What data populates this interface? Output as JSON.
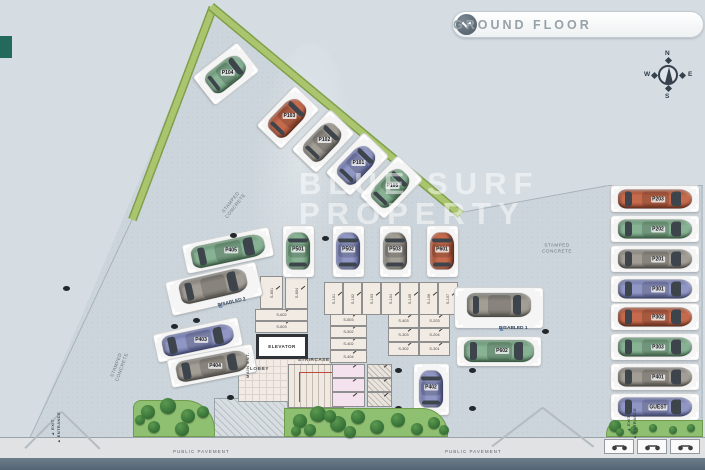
{
  "header": {
    "title": "GROUND FLOOR"
  },
  "compass": {
    "north": "N",
    "east": "E",
    "south": "S",
    "west": "W"
  },
  "watermark": {
    "line1": "BLUE SURF",
    "line2": "PROPERTY"
  },
  "plan": {
    "floor_polygon": [
      [
        213,
        6
      ],
      [
        461,
        213
      ],
      [
        608,
        186
      ],
      [
        703,
        186
      ],
      [
        703,
        438
      ],
      [
        30,
        438
      ]
    ],
    "edges": [
      {
        "x1": 133,
        "y1": 218,
        "x2": 30,
        "y2": 438
      },
      {
        "x1": 461,
        "y1": 213,
        "x2": 608,
        "y2": 186
      },
      {
        "x1": 608,
        "y1": 186,
        "x2": 703,
        "y2": 186
      },
      {
        "x1": 702,
        "y1": 186,
        "x2": 702,
        "y2": 438
      }
    ],
    "green_strips": [
      {
        "x": 213,
        "y": 7,
        "len": 227,
        "angle": 110.8
      },
      {
        "x": 211,
        "y": 6,
        "len": 325,
        "angle": 39.8
      }
    ],
    "driveway_lines": [
      {
        "x1": 62,
        "y1": 412,
        "x2": 25,
        "y2": 449
      },
      {
        "x1": 62,
        "y1": 412,
        "x2": 100,
        "y2": 449
      },
      {
        "x1": 543,
        "y1": 408,
        "x2": 492,
        "y2": 447
      },
      {
        "x1": 543,
        "y1": 408,
        "x2": 594,
        "y2": 447
      }
    ],
    "area_labels": [
      {
        "lines": "STAMPED\nCONCRETE",
        "x": 233,
        "y": 204,
        "rot": -52
      },
      {
        "lines": "STAMPED\nCONCRETE",
        "x": 557,
        "y": 248,
        "rot": 0
      },
      {
        "lines": "STAMPED\nCONCRETE",
        "x": 119,
        "y": 366,
        "rot": -70
      }
    ],
    "pavement_labels": [
      {
        "text": "PUBLIC PAVEMENT",
        "x": 173,
        "y": 449
      },
      {
        "text": "PUBLIC PAVEMENT",
        "x": 445,
        "y": 449
      }
    ],
    "exit_labels": [
      {
        "lines": "▲ EXIT\n▲ ENTRANCE",
        "x": 40,
        "y": 422
      },
      {
        "lines": "▲ EXIT\n▲ ENTRANCE",
        "x": 616,
        "y": 418
      }
    ],
    "rooms": {
      "elevator": {
        "label": "ELEVATOR",
        "x": 256,
        "y": 334,
        "w": 52,
        "h": 25
      },
      "lobby": {
        "label": "LOBBY",
        "x": 238,
        "y": 358,
        "w": 94,
        "h": 44
      },
      "staircase": {
        "label": "STAIRCASE",
        "x": 288,
        "y": 364,
        "w": 56,
        "h": 44
      },
      "main_entrance": {
        "label": "MAIN ENT.",
        "x": 245,
        "y": 378
      },
      "entrance_hatch": {
        "x": 214,
        "y": 398,
        "w": 74,
        "h": 39
      },
      "wall_bar": {
        "x": 386,
        "y": 306,
        "w": 64,
        "h": 5
      }
    },
    "storage_units": [
      {
        "label": "S-601",
        "x": 260,
        "y": 276,
        "w": 23,
        "h": 33,
        "vert": true
      },
      {
        "label": "S-604",
        "x": 285,
        "y": 276,
        "w": 23,
        "h": 33,
        "vert": true
      },
      {
        "label": "S-602",
        "x": 255,
        "y": 309,
        "w": 53,
        "h": 12
      },
      {
        "label": "S-603",
        "x": 255,
        "y": 321,
        "w": 53,
        "h": 12
      },
      {
        "label": "S-101",
        "x": 324,
        "y": 282,
        "w": 19,
        "h": 33,
        "vert": true
      },
      {
        "label": "S-102",
        "x": 343,
        "y": 282,
        "w": 19,
        "h": 33,
        "vert": true
      },
      {
        "label": "S-103",
        "x": 362,
        "y": 282,
        "w": 19,
        "h": 33,
        "vert": true
      },
      {
        "label": "S-104",
        "x": 381,
        "y": 282,
        "w": 19,
        "h": 33,
        "vert": true
      },
      {
        "label": "S-105",
        "x": 400,
        "y": 282,
        "w": 19,
        "h": 33,
        "vert": true
      },
      {
        "label": "S-106",
        "x": 419,
        "y": 282,
        "w": 19,
        "h": 33,
        "vert": true
      },
      {
        "label": "S-107",
        "x": 438,
        "y": 282,
        "w": 20,
        "h": 33,
        "vert": true
      },
      {
        "label": "S-503",
        "x": 330,
        "y": 314,
        "w": 37,
        "h": 12
      },
      {
        "label": "S-502",
        "x": 330,
        "y": 326,
        "w": 37,
        "h": 12
      },
      {
        "label": "S-402",
        "x": 330,
        "y": 338,
        "w": 37,
        "h": 12
      },
      {
        "label": "S-404",
        "x": 330,
        "y": 350,
        "w": 37,
        "h": 13
      },
      {
        "label": "",
        "x": 332,
        "y": 364,
        "w": 33,
        "h": 14,
        "style": "pink"
      },
      {
        "label": "",
        "x": 332,
        "y": 378,
        "w": 33,
        "h": 14,
        "style": "pink"
      },
      {
        "label": "",
        "x": 332,
        "y": 392,
        "w": 33,
        "h": 15,
        "style": "pink"
      },
      {
        "label": "",
        "x": 367,
        "y": 364,
        "w": 25,
        "h": 14,
        "style": "hatch"
      },
      {
        "label": "",
        "x": 367,
        "y": 378,
        "w": 25,
        "h": 14,
        "style": "hatch"
      },
      {
        "label": "",
        "x": 367,
        "y": 392,
        "w": 25,
        "h": 15,
        "style": "hatch"
      },
      {
        "label": "S-403",
        "x": 388,
        "y": 314,
        "w": 31,
        "h": 14
      },
      {
        "label": "S-203",
        "x": 419,
        "y": 314,
        "w": 31,
        "h": 14
      },
      {
        "label": "S-303",
        "x": 388,
        "y": 328,
        "w": 31,
        "h": 14
      },
      {
        "label": "S-204",
        "x": 419,
        "y": 328,
        "w": 31,
        "h": 14
      },
      {
        "label": "S-302",
        "x": 388,
        "y": 342,
        "w": 31,
        "h": 14
      },
      {
        "label": "S-301",
        "x": 419,
        "y": 342,
        "w": 31,
        "h": 14
      }
    ],
    "parking_spots": [
      {
        "label": "P104",
        "cx": 226,
        "cy": 74,
        "w": 36,
        "h": 56,
        "rot": 52,
        "car": 0,
        "color": "green"
      },
      {
        "label": "P103",
        "cx": 288,
        "cy": 117,
        "w": 34,
        "h": 55,
        "rot": 44,
        "car": 0,
        "color": "orange"
      },
      {
        "label": "P102",
        "cx": 323,
        "cy": 141,
        "w": 34,
        "h": 55,
        "rot": 44,
        "car": 0,
        "color": "gray"
      },
      {
        "label": "P101",
        "cx": 357,
        "cy": 164,
        "w": 34,
        "h": 55,
        "rot": 44,
        "car": 0,
        "color": "blue"
      },
      {
        "label": "P105",
        "cx": 391,
        "cy": 187,
        "w": 34,
        "h": 55,
        "rot": 44,
        "car": 0,
        "color": "green"
      },
      {
        "label": "P405",
        "cx": 228,
        "cy": 250,
        "w": 88,
        "h": 29,
        "rot": -12,
        "car": 90,
        "color": "green"
      },
      {
        "label": "DISABLED 2",
        "cx": 214,
        "cy": 289,
        "w": 92,
        "h": 34,
        "rot": -13,
        "car": 90,
        "color": "gray",
        "type": "disabled"
      },
      {
        "label": "P403",
        "cx": 198,
        "cy": 340,
        "w": 86,
        "h": 28,
        "rot": -12,
        "car": 90,
        "color": "blue"
      },
      {
        "label": "P404",
        "cx": 212,
        "cy": 366,
        "w": 86,
        "h": 28,
        "rot": -11,
        "car": 90,
        "color": "gray"
      },
      {
        "label": "P501",
        "cx": 298,
        "cy": 251,
        "w": 31,
        "h": 51,
        "rot": 0,
        "car": 0,
        "color": "green"
      },
      {
        "label": "P502",
        "cx": 348,
        "cy": 251,
        "w": 31,
        "h": 51,
        "rot": 0,
        "car": 0,
        "color": "blue"
      },
      {
        "label": "P503",
        "cx": 395,
        "cy": 251,
        "w": 31,
        "h": 51,
        "rot": 0,
        "car": 0,
        "color": "gray"
      },
      {
        "label": "P601",
        "cx": 442,
        "cy": 251,
        "w": 31,
        "h": 51,
        "rot": 0,
        "car": 0,
        "color": "orange"
      },
      {
        "label": "DISABLED 1",
        "cx": 499,
        "cy": 308,
        "w": 88,
        "h": 40,
        "rot": 0,
        "car": 90,
        "color": "gray",
        "type": "disabled"
      },
      {
        "label": "P602",
        "cx": 499,
        "cy": 351,
        "w": 84,
        "h": 29,
        "rot": 0,
        "car": 90,
        "color": "green"
      },
      {
        "label": "P402",
        "cx": 431,
        "cy": 389,
        "w": 35,
        "h": 51,
        "rot": 0,
        "car": 0,
        "color": "blue"
      },
      {
        "label": "P203",
        "cx": 655,
        "cy": 199,
        "w": 88,
        "h": 26,
        "rot": 0,
        "car": 90,
        "color": "orange"
      },
      {
        "label": "P202",
        "cx": 655,
        "cy": 229,
        "w": 88,
        "h": 26,
        "rot": 0,
        "car": 90,
        "color": "green"
      },
      {
        "label": "P201",
        "cx": 655,
        "cy": 259,
        "w": 88,
        "h": 26,
        "rot": 0,
        "car": 90,
        "color": "gray"
      },
      {
        "label": "P301",
        "cx": 655,
        "cy": 289,
        "w": 88,
        "h": 26,
        "rot": 0,
        "car": 90,
        "color": "blue"
      },
      {
        "label": "P302",
        "cx": 655,
        "cy": 317,
        "w": 88,
        "h": 26,
        "rot": 0,
        "car": 90,
        "color": "orange"
      },
      {
        "label": "P303",
        "cx": 655,
        "cy": 347,
        "w": 88,
        "h": 26,
        "rot": 0,
        "car": 90,
        "color": "green"
      },
      {
        "label": "P401",
        "cx": 655,
        "cy": 377,
        "w": 88,
        "h": 26,
        "rot": 0,
        "car": 90,
        "color": "gray"
      },
      {
        "label": "GUEST",
        "cx": 655,
        "cy": 407,
        "w": 88,
        "h": 26,
        "rot": 0,
        "car": 90,
        "color": "blue"
      }
    ],
    "columns": [
      [
        233,
        235
      ],
      [
        325,
        238
      ],
      [
        174,
        326
      ],
      [
        196,
        320
      ],
      [
        230,
        397
      ],
      [
        66,
        288
      ],
      [
        545,
        331
      ],
      [
        398,
        370
      ],
      [
        472,
        370
      ],
      [
        398,
        408
      ],
      [
        472,
        408
      ]
    ],
    "grass_patches": [
      {
        "x": 133,
        "y": 400,
        "w": 82,
        "h": 37,
        "radius": "8px 30px 0 0"
      },
      {
        "x": 284,
        "y": 408,
        "w": 164,
        "h": 29,
        "radius": "0 26px 0 0"
      },
      {
        "x": 606,
        "y": 420,
        "w": 97,
        "h": 17,
        "radius": "14px 0 0 0"
      }
    ],
    "bushes": [
      [
        148,
        412,
        7
      ],
      [
        168,
        406,
        8
      ],
      [
        188,
        416,
        7
      ],
      [
        154,
        427,
        6
      ],
      [
        182,
        429,
        7
      ],
      [
        203,
        412,
        6
      ],
      [
        140,
        420,
        5
      ],
      [
        300,
        421,
        7
      ],
      [
        318,
        414,
        8
      ],
      [
        338,
        424,
        8
      ],
      [
        358,
        417,
        7
      ],
      [
        377,
        427,
        7
      ],
      [
        398,
        420,
        7
      ],
      [
        417,
        429,
        6
      ],
      [
        434,
        423,
        6
      ],
      [
        296,
        431,
        5
      ],
      [
        350,
        432,
        6
      ],
      [
        310,
        430,
        6
      ],
      [
        330,
        416,
        6
      ],
      [
        444,
        430,
        5
      ],
      [
        615,
        426,
        6
      ],
      [
        634,
        430,
        4
      ],
      [
        653,
        428,
        4
      ],
      [
        673,
        430,
        4
      ],
      [
        691,
        428,
        4
      ],
      [
        620,
        432,
        4
      ]
    ],
    "bike_parking": [
      {
        "x": 604,
        "y": 439
      },
      {
        "x": 637,
        "y": 439
      },
      {
        "x": 670,
        "y": 439
      }
    ]
  },
  "colors": {
    "green": {
      "base": "#87b294",
      "dark": "#5a8a66"
    },
    "orange": {
      "base": "#c56a4c",
      "dark": "#97452c"
    },
    "gray": {
      "base": "#a39e95",
      "dark": "#73706a"
    },
    "blue": {
      "base": "#9097c4",
      "dark": "#5f67a0"
    }
  }
}
